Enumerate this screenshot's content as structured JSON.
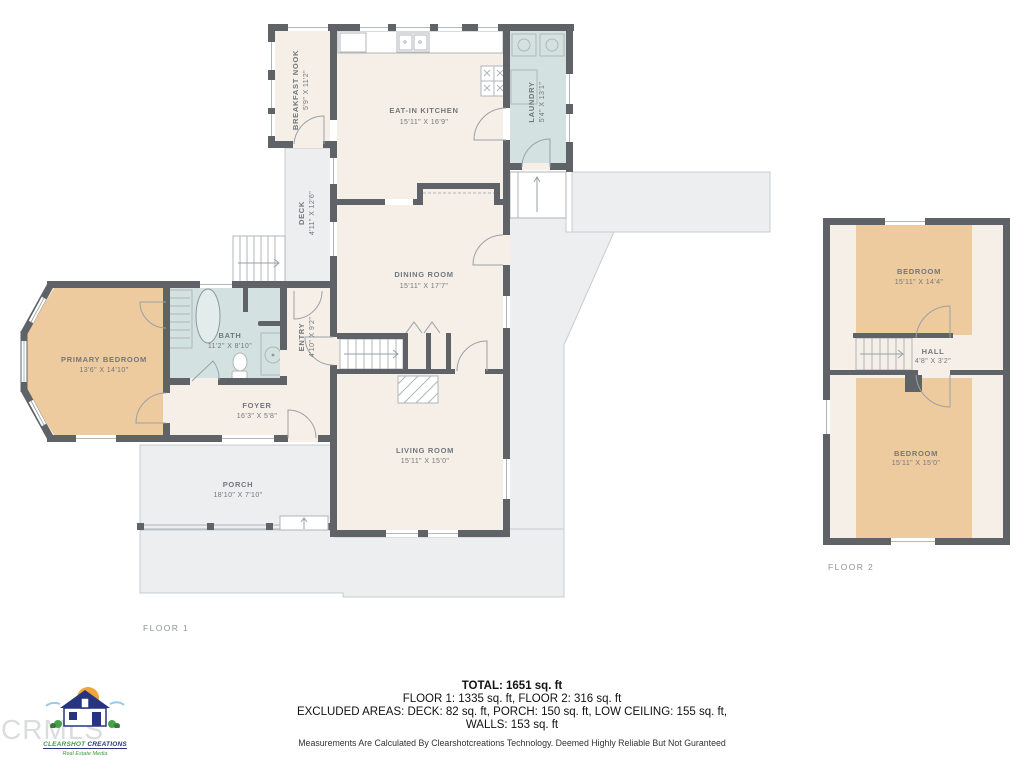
{
  "floor1": {
    "label": "FLOOR 1",
    "rooms": [
      {
        "name": "BREAKFAST NOOK",
        "dims": "5'9\" X 11'2\""
      },
      {
        "name": "EAT-IN KITCHEN",
        "dims": "15'11\" X 16'9\""
      },
      {
        "name": "LAUNDRY",
        "dims": "5'4\" X 13'1\""
      },
      {
        "name": "DECK",
        "dims": "4'11\" X 12'6\""
      },
      {
        "name": "DINING ROOM",
        "dims": "15'11\" X 17'7\""
      },
      {
        "name": "ENTRY",
        "dims": "4'10\" X 9'2\""
      },
      {
        "name": "BATH",
        "dims": "11'2\" X 8'10\""
      },
      {
        "name": "PRIMARY BEDROOM",
        "dims": "13'6\" X 14'10\""
      },
      {
        "name": "FOYER",
        "dims": "16'3\" X 5'8\""
      },
      {
        "name": "LIVING ROOM",
        "dims": "15'11\" X 15'0\""
      },
      {
        "name": "PORCH",
        "dims": "18'10\" X 7'10\""
      }
    ]
  },
  "floor2": {
    "label": "FLOOR 2",
    "rooms": [
      {
        "name": "BEDROOM",
        "dims": "15'11\" X 14'4\""
      },
      {
        "name": "HALL",
        "dims": "4'8\" X 3'2\""
      },
      {
        "name": "BEDROOM",
        "dims": "15'11\" X 15'0\""
      }
    ]
  },
  "summary": {
    "total": "TOTAL: 1651 sq. ft",
    "floors": "FLOOR 1: 1335 sq. ft, FLOOR 2: 316 sq. ft",
    "excluded1": "EXCLUDED AREAS: DECK: 82 sq. ft, PORCH: 150 sq. ft, LOW CEILING: 155 sq. ft,",
    "excluded2": "WALLS: 153 sq. ft",
    "disclaimer": "Measurements Are Calculated By Clearshotcreations Technology. Deemed Highly Reliable But Not Guranteed"
  },
  "branding": {
    "watermark": "CRMLS",
    "logo_part1": "CLEARSHOT",
    "logo_part2": " CREATIONS",
    "tagline": "Real Estate Media"
  },
  "colors": {
    "wall": "#5f6367",
    "floor_cream": "#f6efe7",
    "wet_room_blue": "#d3e2e1",
    "bedroom_tan": "#eecb9f",
    "outdoor_gray": "#eceeef"
  }
}
